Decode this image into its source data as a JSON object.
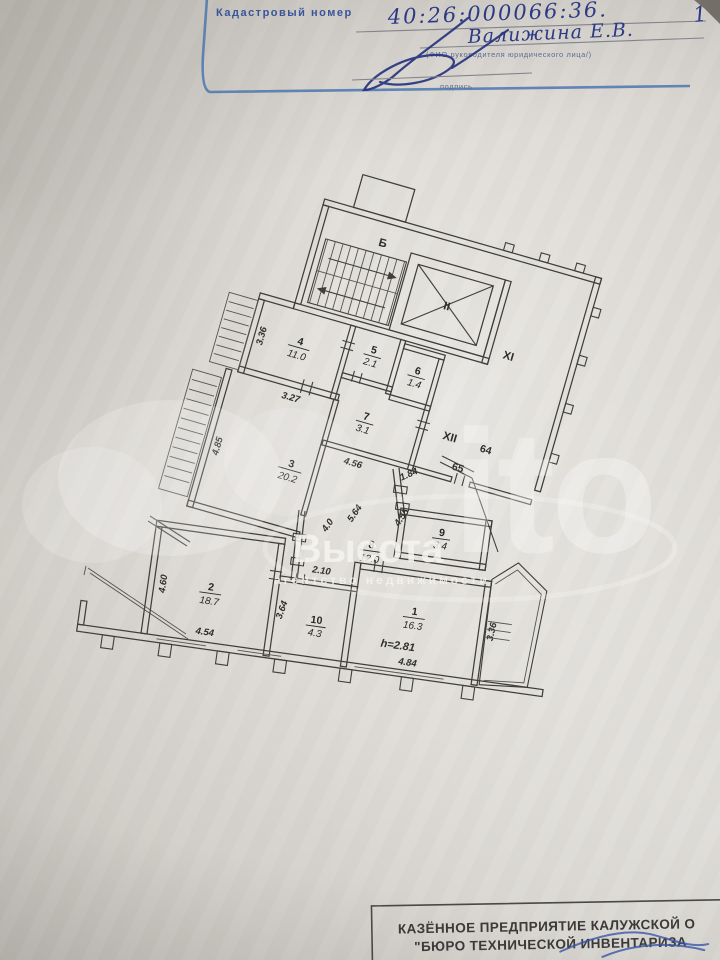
{
  "header": {
    "label": "Кадастровый номер",
    "value": "40:26:000066:36.",
    "page_mark": "1",
    "name": "Валижина Е.В.",
    "name_caption": "(ФИО руководителя юридического лица/)",
    "sign_caption": "подпись"
  },
  "plan": {
    "stairs_label": "Б",
    "elevator_label": "II",
    "hall_label": "XI",
    "landing_label": "XII",
    "flat_64": "64",
    "flat_65": "65",
    "ceiling_height": "h=2.81",
    "rooms": [
      {
        "num": "1",
        "area": "16.3"
      },
      {
        "num": "2",
        "area": "18.7"
      },
      {
        "num": "3",
        "area": "20.2"
      },
      {
        "num": "4",
        "area": "11.0"
      },
      {
        "num": "5",
        "area": "2.1"
      },
      {
        "num": "6",
        "area": "1.4"
      },
      {
        "num": "7",
        "area": "3.1"
      },
      {
        "num": "8",
        "area": "12.0"
      },
      {
        "num": "9",
        "area": "3.4"
      },
      {
        "num": "10",
        "area": "4.3"
      }
    ],
    "dims": {
      "room4_left": "3.36",
      "room4_bottom": "3.27",
      "room7_wall": "4.56",
      "room3_left": "4.85",
      "corr_a": "4.0",
      "corr_b": "5.64",
      "corr_c": "4.55",
      "landing": "1.84",
      "room2_left": "4.60",
      "room2_bottom": "4.54",
      "room2_right": "3.64",
      "room10_top": "2.10",
      "room1_bottom": "4.84",
      "room1_right": "3.36"
    }
  },
  "watermark": {
    "avito_fragment": "ito",
    "agency": "Высота",
    "agency_sub": "агентство недвижимости"
  },
  "footer": {
    "line1": "КАЗЁННОЕ ПРЕДПРИЯТИЕ КАЛУЖСКОЙ О",
    "line2": "\"БЮРО ТЕХНИЧЕСКОЙ ИНВЕНТАРИЗА"
  }
}
